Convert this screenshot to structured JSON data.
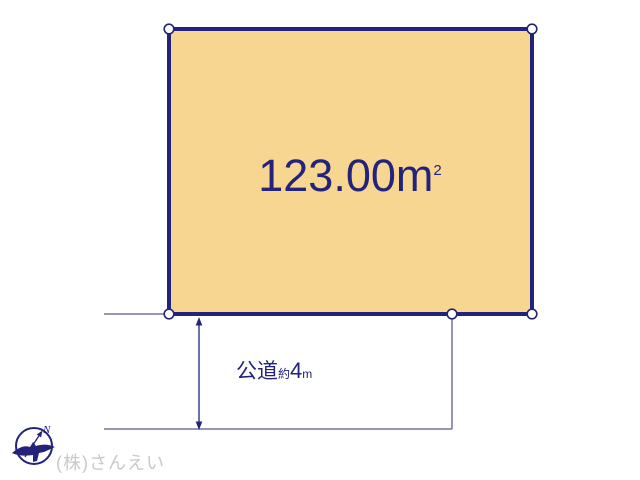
{
  "colors": {
    "navy": "#23237b",
    "lot": "#f7d691",
    "thin": "#73739e",
    "wm": "#c9c9c9",
    "bg": "#ffffff"
  },
  "lot": {
    "area_value": "123.00",
    "area_unit": "m",
    "area_exponent": "2"
  },
  "road": {
    "name": "公道",
    "approx": "約",
    "width_value": "4",
    "width_unit": "m"
  },
  "compass": {
    "north_label": "N"
  },
  "footer": {
    "company": "(株)さんえい"
  }
}
